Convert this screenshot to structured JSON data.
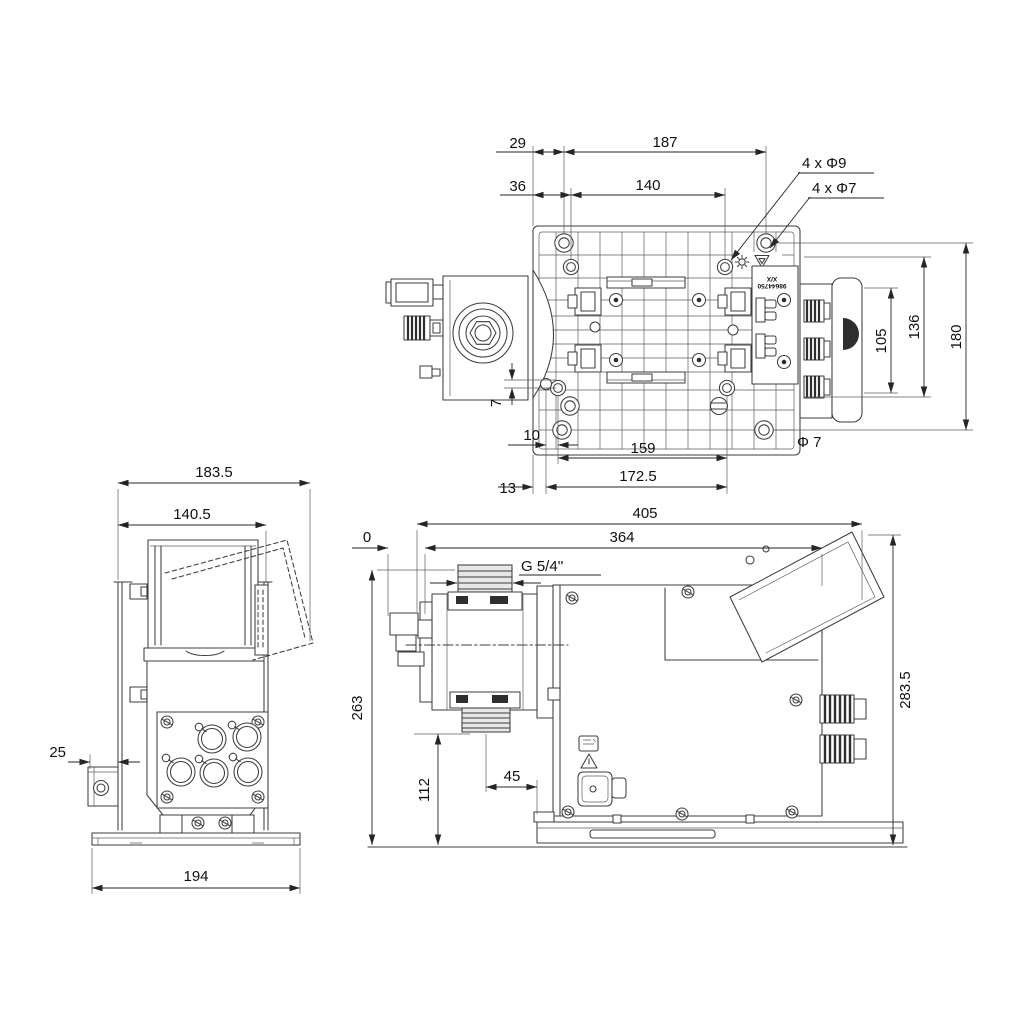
{
  "colors": {
    "background": "#ffffff",
    "line": "#3d3d3d",
    "dimension": "#252525",
    "text": "#111111"
  },
  "top_view": {
    "dim_29": "29",
    "dim_187": "187",
    "dim_36": "36",
    "dim_140": "140",
    "hole_label_phi9": "4 x Φ9",
    "hole_label_phi7": "4 x Φ7",
    "dim_105": "105",
    "dim_136": "136",
    "dim_180": "180",
    "dim_7": "7",
    "dim_10": "10",
    "dim_159": "159",
    "label_phi7": "Φ 7",
    "dim_13": "13",
    "dim_172_5": "172.5",
    "molded_line_top": "X/X",
    "molded_line_bottom": "98644750"
  },
  "front_view": {
    "dim_183_5": "183.5",
    "dim_140_5": "140.5",
    "dim_25": "25",
    "dim_194": "194"
  },
  "side_view": {
    "dim_405": "405",
    "dim_364": "364",
    "datum_0": "0",
    "thread_label": "G 5/4''",
    "dim_263": "263",
    "dim_112": "112",
    "dim_45": "45",
    "dim_283_5": "283.5"
  }
}
